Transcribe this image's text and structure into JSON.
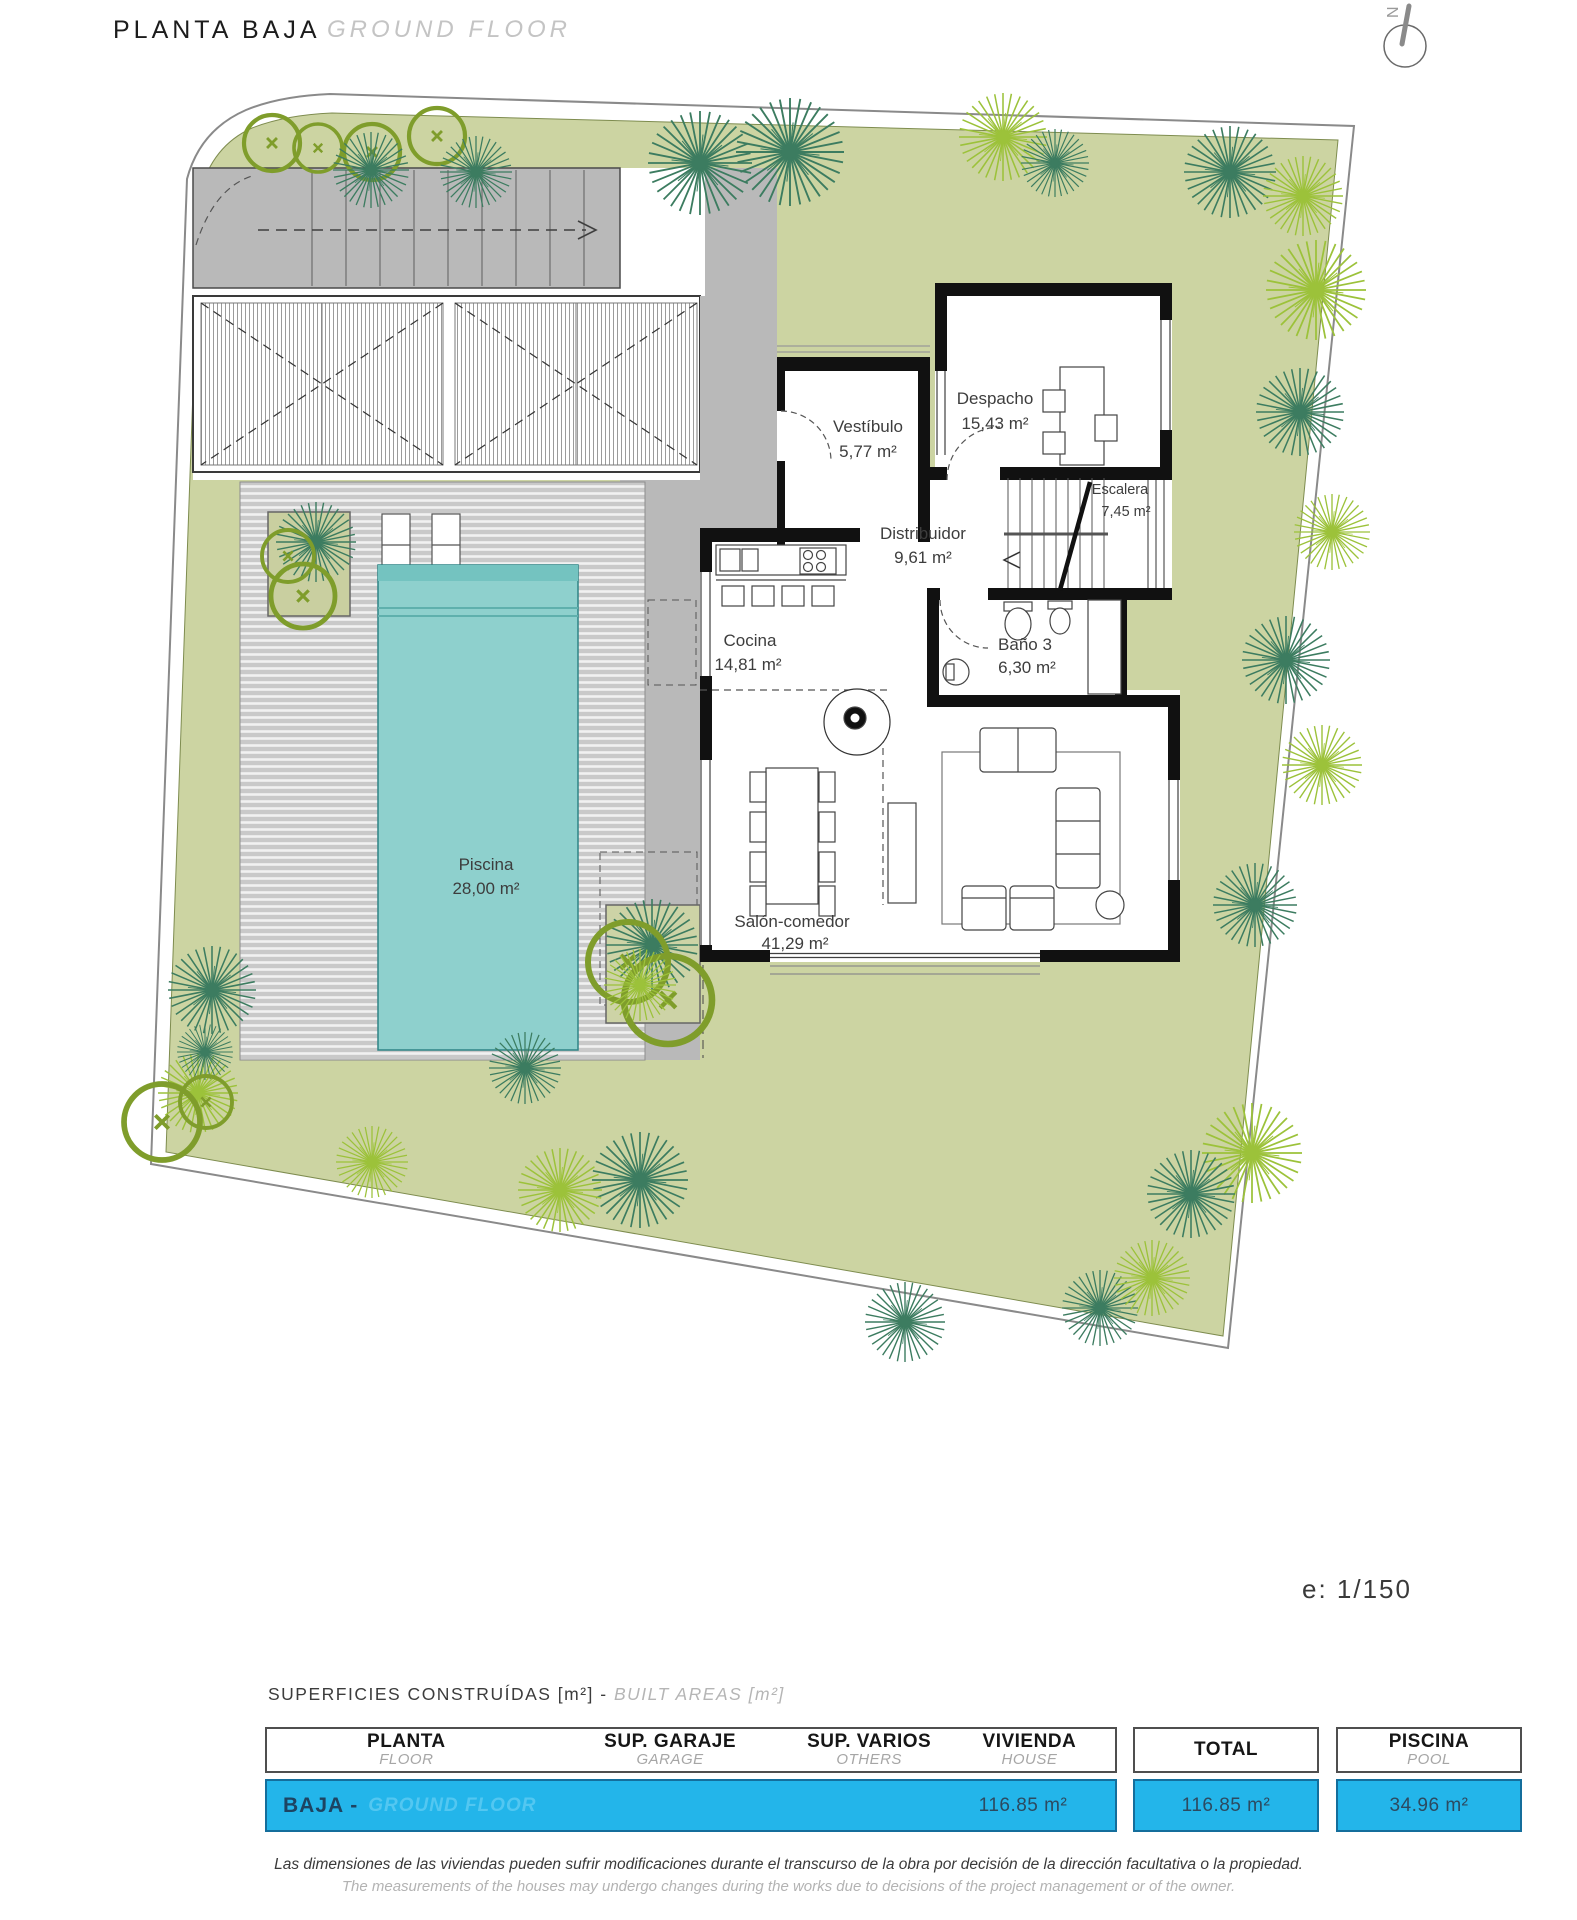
{
  "header": {
    "title": "PLANTA BAJA",
    "subtitle": "GROUND FLOOR"
  },
  "compass": {
    "north": "N"
  },
  "plan": {
    "scale": "e: 1/150",
    "rooms": [
      {
        "name": "Vestíbulo",
        "area": "5,77 m²"
      },
      {
        "name": "Despacho",
        "area": "15,43 m²"
      },
      {
        "name": "Escalera",
        "area": "7,45 m²"
      },
      {
        "name": "Distribuidor",
        "area": "9,61 m²"
      },
      {
        "name": "Cocina",
        "area": "14,81 m²"
      },
      {
        "name": "Baño 3",
        "area": "6,30 m²"
      },
      {
        "name": "Salón-comedor",
        "area": "41,29 m²"
      },
      {
        "name": "Piscina",
        "area": "28,00 m²"
      }
    ]
  },
  "areas_table": {
    "section_title_es": "SUPERFICIES CONSTRUÍDAS [m²] - ",
    "section_title_en": "BUILT AREAS [m²]",
    "columns": [
      {
        "label": "PLANTA",
        "sublabel": "FLOOR"
      },
      {
        "label": "SUP. GARAJE",
        "sublabel": "GARAGE"
      },
      {
        "label": "SUP. VARIOS",
        "sublabel": "OTHERS"
      },
      {
        "label": "VIVIENDA",
        "sublabel": "HOUSE"
      },
      {
        "label": "TOTAL",
        "sublabel": ""
      },
      {
        "label": "PISCINA",
        "sublabel": "POOL"
      }
    ],
    "row": {
      "floor": "BAJA -",
      "floor_en": "GROUND FLOOR",
      "house": "116.85 m²",
      "total": "116.85 m²",
      "pool": "34.96 m²"
    }
  },
  "disclaimer": {
    "es": "Las dimensiones de las viviendas pueden sufrir modificaciones durante el transcurso de la obra por decisión de la dirección facultativa o la propiedad.",
    "en": "The measurements of the houses may undergo changes during the works due to decisions of the project management or of the owner."
  },
  "colors": {
    "lawn": "#ccd4a2",
    "deck_gray": "#c9c9c9",
    "terrace_gray": "#b9b9b9",
    "pool": "#8ed0cd",
    "accent_blue": "#23b5ea",
    "row_text": "#2c4a60"
  }
}
